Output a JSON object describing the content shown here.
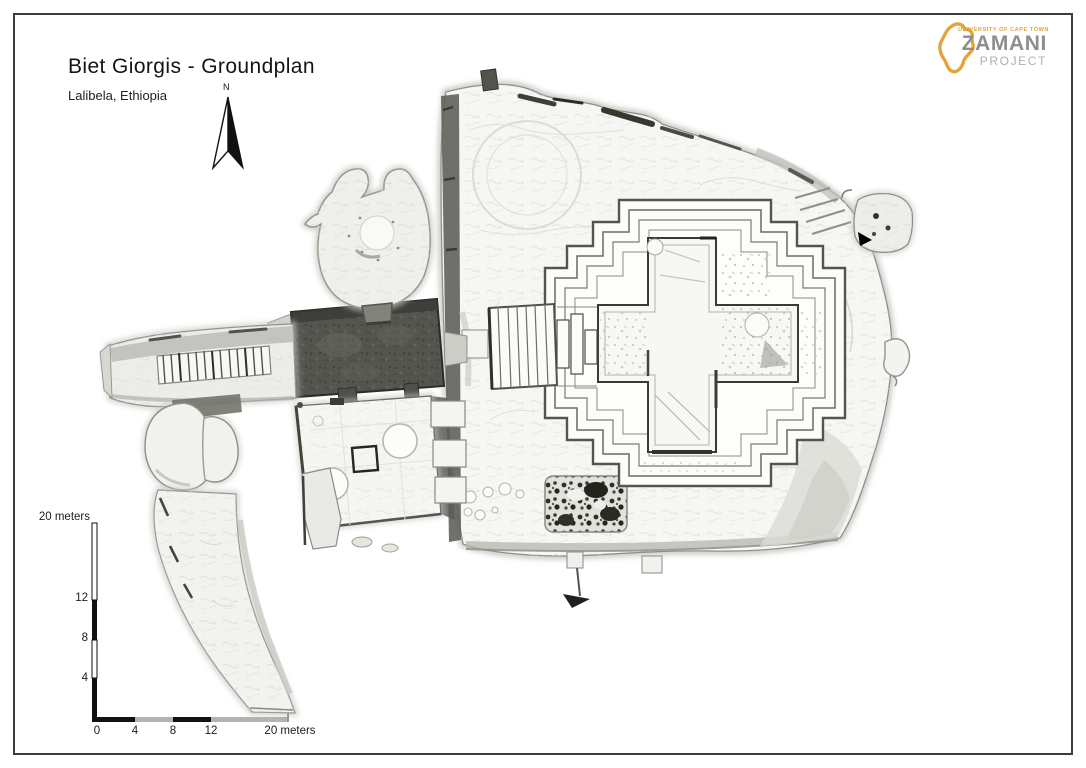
{
  "page": {
    "title": "Biet Giorgis - Groundplan",
    "subtitle": "Lalibela, Ethiopia"
  },
  "north_arrow": {
    "label": "N"
  },
  "logo": {
    "org": "UNIVERSITY OF CAPE TOWN",
    "name": "ZAMANI",
    "sub": "PROJECT",
    "accent_color": "#E5A23C",
    "name_color": "#8E8E8E"
  },
  "scale_vertical": {
    "top_label": "20 meters",
    "ticks": [
      "12",
      "8",
      "4"
    ]
  },
  "scale_horizontal": {
    "ticks": [
      "0",
      "4",
      "8",
      "12"
    ],
    "end_label": "20 meters"
  },
  "colors": {
    "page_border": "#3D3D3D",
    "ink": "#1A1A1A",
    "scale_gray": "#B3B3B3",
    "rock_light": "#F6F6F4",
    "rock_dark": "#55554F"
  }
}
